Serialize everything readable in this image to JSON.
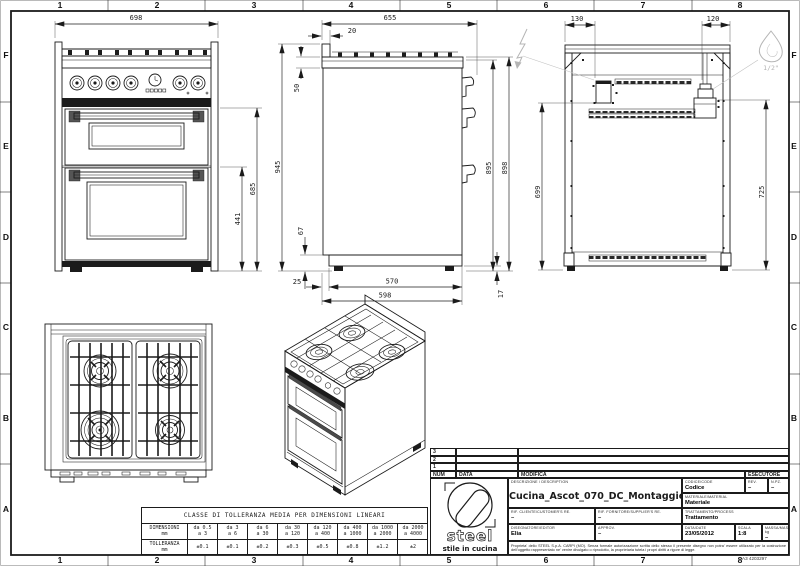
{
  "sheet": {
    "cols": [
      "1",
      "2",
      "3",
      "4",
      "5",
      "6",
      "7",
      "8"
    ],
    "rows": [
      "F",
      "E",
      "D",
      "C",
      "B",
      "A"
    ],
    "code": "A3 4203297"
  },
  "dims": {
    "front_width": "698",
    "front_height": "685",
    "front_lower": "441",
    "side_depth": "655",
    "side_top_offset": "20",
    "side_splash": "50",
    "side_total_height": "945",
    "side_plinth": "67",
    "side_back_h1": "895",
    "side_back_h2": "898",
    "side_inset": "25",
    "side_base": "570",
    "side_overall": "598",
    "side_foot": "17",
    "back_elec_offset": "130",
    "back_gas_offset": "120",
    "back_elec_height": "699",
    "back_gas_height": "725",
    "gas_thread": "1/2\""
  },
  "tolerance_table": {
    "title": "CLASSE DI TOLLERANZA MEDIA PER DIMENSIONI LINEARI",
    "dim_label": "DIMENSIONI",
    "dim_unit": "mm",
    "tol_label": "TOLLERANZA",
    "tol_unit": "mm",
    "ranges_from": [
      "da 0.5",
      "da 3",
      "da 6",
      "da 30",
      "da 120",
      "da 400",
      "da 1000",
      "da 2000"
    ],
    "ranges_to": [
      "a 3",
      "a 6",
      "a 30",
      "a 120",
      "a 400",
      "a 1000",
      "a 2000",
      "a 4000"
    ],
    "tolerances": [
      "±0.1",
      "±0.1",
      "±0.2",
      "±0.3",
      "±0.5",
      "±0.8",
      "±1.2",
      "±2"
    ]
  },
  "title_block": {
    "rev_rows": [
      "3",
      "2",
      "1"
    ],
    "headers": {
      "num": "NUM",
      "data": "DATA",
      "modifica": "MODIFICA",
      "esecutore": "ESECUTORE"
    },
    "logo": {
      "name": "steel",
      "tagline": "stile in cucina"
    },
    "description_label": "DESCRIZIONE / DESCRIPTION",
    "description": "Cucina_Ascot_070_DC_Montaggio",
    "codice_label": "CODICE/CODE",
    "codice": "Codice",
    "rev_label": "REV.",
    "rev": "–",
    "npz_label": "N.PZ.",
    "npz": "–",
    "materiale_label": "MATERIALE/MATERIAL",
    "materiale": "Materiale",
    "trattamento_label": "TRATTAMENTO/PROCESS",
    "trattamento": "Trattamento",
    "rif_cliente_label": "RIF. CLIENTE/CUSTOMER'S RE.",
    "rif_cliente": "–",
    "rif_fornitore_label": "RIF. FORNITORE/SUPPLIER'S RE.",
    "rif_fornitore": "–",
    "disegnatore_label": "DISEGNATORE/EDITOR",
    "disegnatore": "Elia",
    "approv_label": "APPROV.",
    "approv": "–",
    "data_label": "DATA/DATE",
    "data": "23/05/2012",
    "scala_label": "SCALA",
    "scala": "1:8",
    "massa_label": "MASSA/MASS kg",
    "massa": "–",
    "legal": "Proprieta' dello STEEL S.p.A. CARPI (MO). Senza formale autorizzazione scritta dello stesso il presente disegno non potra' essere utilizzato per la costruzione dell'oggetto rappresentato ne' venire divulgato o riprodotto, la proprietaria tutela i propri diritti a rigore di legge."
  }
}
